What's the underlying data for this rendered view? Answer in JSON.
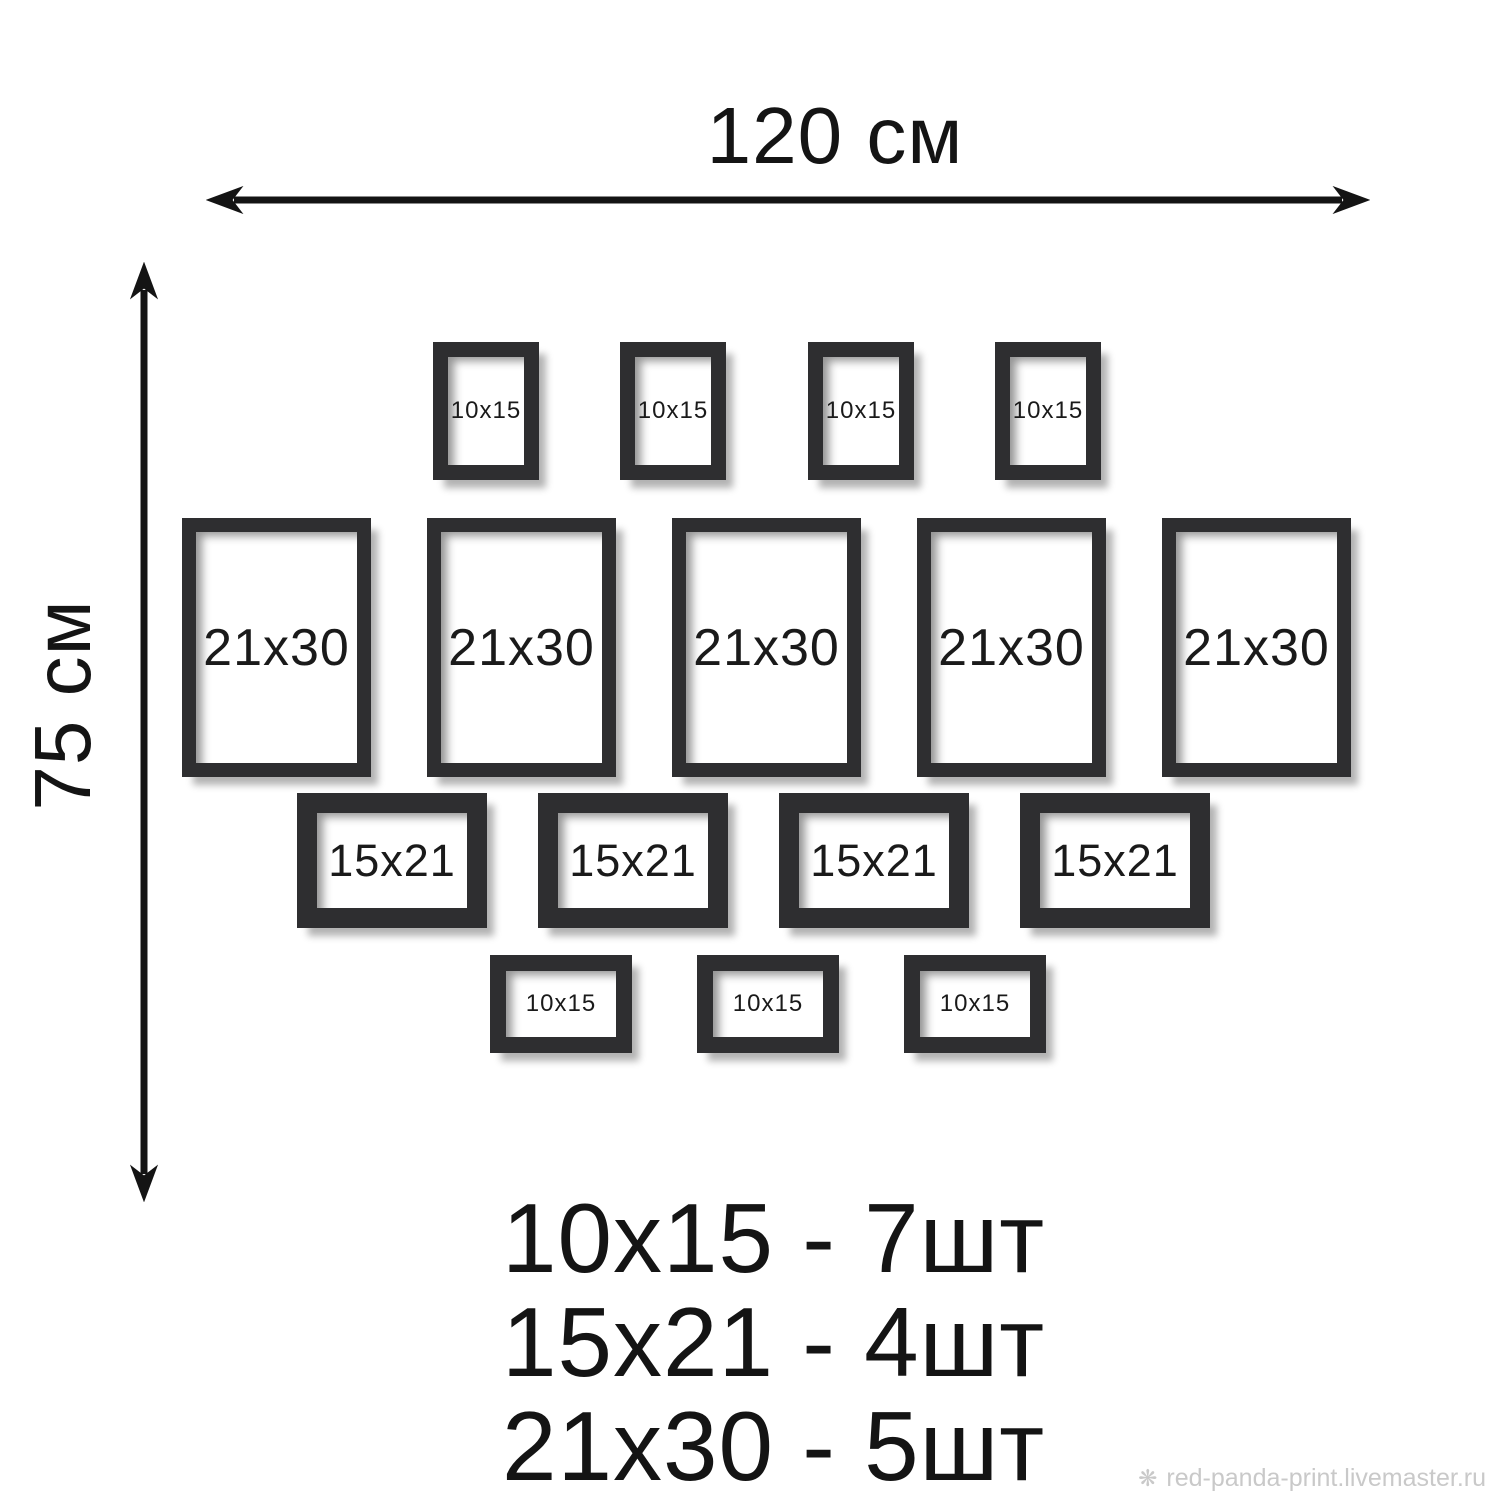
{
  "dimension_width": {
    "label": "120 см"
  },
  "dimension_height": {
    "label": "75 см"
  },
  "frames": [
    {
      "label": "10x15",
      "x": 433,
      "y": 342,
      "w": 106,
      "h": 138,
      "border": 15,
      "font": 24
    },
    {
      "label": "10x15",
      "x": 620,
      "y": 342,
      "w": 106,
      "h": 138,
      "border": 15,
      "font": 24
    },
    {
      "label": "10x15",
      "x": 808,
      "y": 342,
      "w": 106,
      "h": 138,
      "border": 15,
      "font": 24
    },
    {
      "label": "10x15",
      "x": 995,
      "y": 342,
      "w": 106,
      "h": 138,
      "border": 15,
      "font": 24
    },
    {
      "label": "21x30",
      "x": 182,
      "y": 518,
      "w": 189,
      "h": 259,
      "border": 14,
      "font": 52
    },
    {
      "label": "21x30",
      "x": 427,
      "y": 518,
      "w": 189,
      "h": 259,
      "border": 14,
      "font": 52
    },
    {
      "label": "21x30",
      "x": 672,
      "y": 518,
      "w": 189,
      "h": 259,
      "border": 14,
      "font": 52
    },
    {
      "label": "21x30",
      "x": 917,
      "y": 518,
      "w": 189,
      "h": 259,
      "border": 14,
      "font": 52
    },
    {
      "label": "21x30",
      "x": 1162,
      "y": 518,
      "w": 189,
      "h": 259,
      "border": 14,
      "font": 52
    },
    {
      "label": "15x21",
      "x": 297,
      "y": 793,
      "w": 190,
      "h": 135,
      "border": 20,
      "font": 45
    },
    {
      "label": "15x21",
      "x": 538,
      "y": 793,
      "w": 190,
      "h": 135,
      "border": 20,
      "font": 45
    },
    {
      "label": "15x21",
      "x": 779,
      "y": 793,
      "w": 190,
      "h": 135,
      "border": 20,
      "font": 45
    },
    {
      "label": "15x21",
      "x": 1020,
      "y": 793,
      "w": 190,
      "h": 135,
      "border": 20,
      "font": 45
    },
    {
      "label": "10x15",
      "x": 490,
      "y": 955,
      "w": 142,
      "h": 98,
      "border": 16,
      "font": 24
    },
    {
      "label": "10x15",
      "x": 697,
      "y": 955,
      "w": 142,
      "h": 98,
      "border": 16,
      "font": 24
    },
    {
      "label": "10x15",
      "x": 904,
      "y": 955,
      "w": 142,
      "h": 98,
      "border": 16,
      "font": 24
    }
  ],
  "legend": {
    "lines": [
      "10x15 - 7шт",
      "15x21 - 4шт",
      "21x30 - 5шт"
    ]
  },
  "watermark": {
    "icon": "flower-icon",
    "icon_glyph": "❋",
    "text": "red-panda-print.livemaster.ru"
  },
  "colors": {
    "frame": "#2e2e30",
    "ink": "#141414",
    "watermark": "#c9c9c9"
  }
}
